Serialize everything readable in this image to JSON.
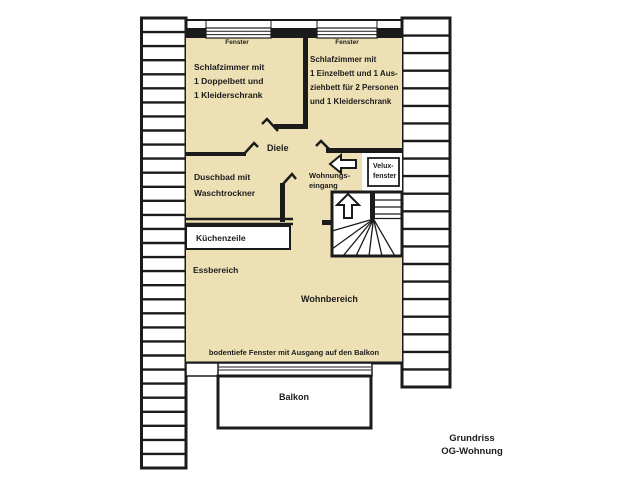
{
  "title": "Grundriss OG-Wohnung",
  "colors": {
    "floor_fill": "#ede0b4",
    "wall": "#1b1b1b",
    "background": "#ffffff"
  },
  "plan": {
    "left_hatch_cells": 32,
    "right_hatch_cells": 21
  },
  "labels": {
    "bedroom_left": "Schlafzimmer mit\n1 Doppelbett und\n1 Kleiderschrank",
    "bedroom_right": "Schlafzimmer mit\n1 Einzelbett und 1 Aus-\nziehbett für 2 Personen\nund 1 Kleiderschrank",
    "hallway": "Diele",
    "bathroom": "Duschbad mit\nWaschtrockner",
    "kitchenette": "Küchenzeile",
    "dining_area": "Essbereich",
    "living_area": "Wohnbereich",
    "apartment_entrance": "Wohnungs-\neingang",
    "velux_window": "Velux-\nfenster",
    "window_top_left": "Fenster",
    "window_top_right": "Fenster",
    "floor_to_ceiling_windows": "bodentiefe Fenster mit Ausgang auf den Balkon",
    "balcony": "Balkon",
    "caption": "Grundriss\nOG-Wohnung"
  }
}
